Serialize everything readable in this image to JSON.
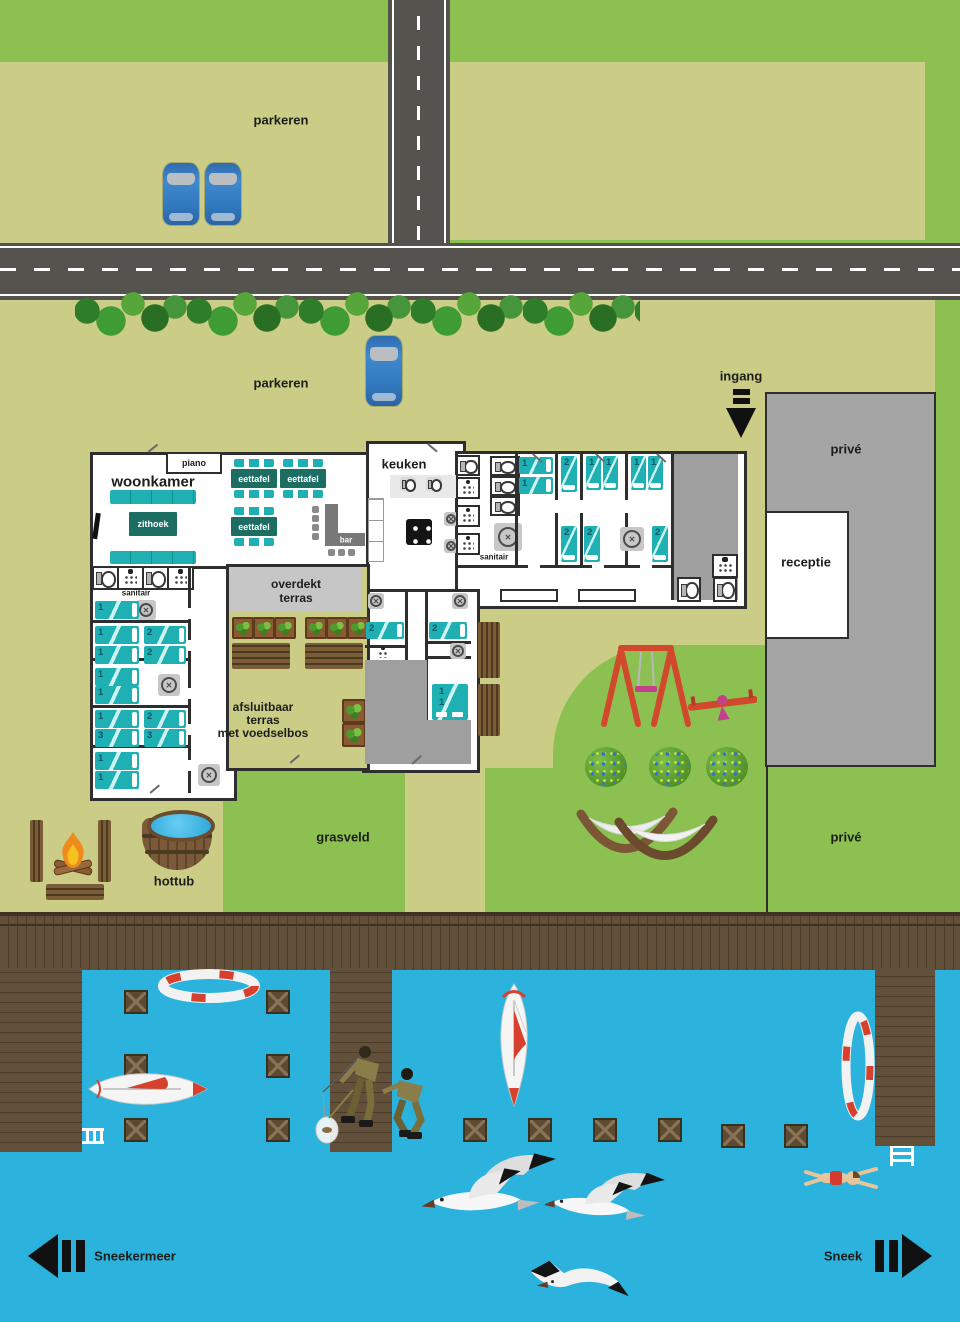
{
  "scene": {
    "parking_top_label": "parkeren",
    "parking_mid_label": "parkeren",
    "entrance_label": "ingang",
    "private_upper_label": "privé",
    "private_lower_label": "privé",
    "reception_label": "receptie",
    "grass_label": "grasveld",
    "hottub_label": "hottub",
    "lake_label": "Sneekermeer",
    "town_label": "Sneek"
  },
  "building": {
    "living_room": "woonkamer",
    "piano": "piano",
    "sitting_area": "zithoek",
    "dining_table": "eettafel",
    "bar": "bar",
    "kitchen": "keuken",
    "sanitary": "sanitair",
    "covered_terrace_line1": "overdekt",
    "covered_terrace_line2": "terras",
    "closable_terrace_line1": "afsluitbaar",
    "closable_terrace_line2": "terras",
    "closable_terrace_line3": "met voedselbos"
  },
  "beds": {
    "west": [
      "1",
      "1",
      "2",
      "1",
      "2",
      "1",
      "1",
      "1",
      "2",
      "3",
      "3",
      "1",
      "1"
    ],
    "east_top": [
      "1",
      "1",
      "2",
      "1",
      "1",
      "1",
      "1"
    ],
    "east_bottom": [
      "2",
      "2",
      "2"
    ],
    "south": [
      "2",
      "2",
      "1 1"
    ]
  },
  "colors": {
    "grass": "#8cc152",
    "ground": "#cbcd86",
    "road": "#55534e",
    "water": "#2bb3dd",
    "wood": "#63503a",
    "teal": "#1fb0b4",
    "wall": "#2e2e2e",
    "label_teal": "#1c6e62",
    "gray_area": "#9f9f9f",
    "accent_red": "#d6402c"
  }
}
